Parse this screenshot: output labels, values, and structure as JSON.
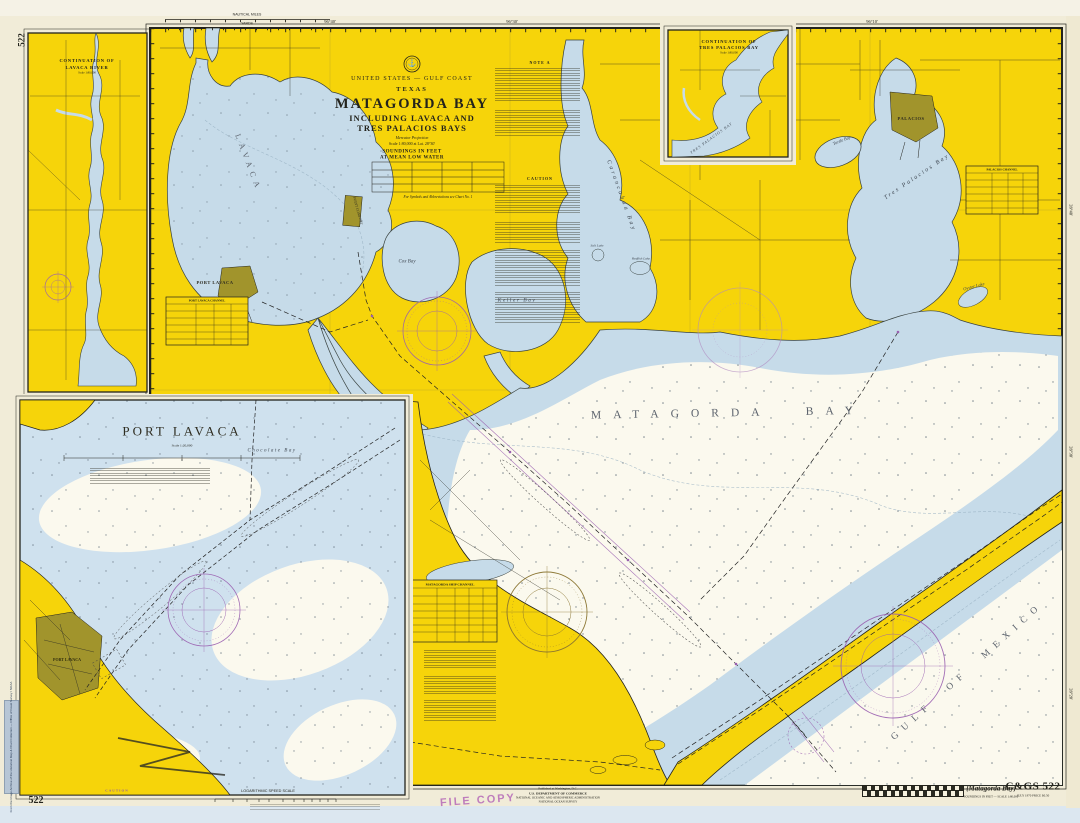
{
  "sheet": {
    "corner_number": "522",
    "chart_number": "C&GS 522",
    "chart_number_sub": "JULY 1970      PRICE $0.50",
    "bracket_title": "{Matagorda Bay}",
    "bracket_sub": "SOUNDINGS IN FEET — SCALE 1:80,000",
    "file_stamp": "FILE COPY",
    "publisher_l1": "Published at Washington, D.C.",
    "publisher_l2": "U.S. DEPARTMENT OF COMMERCE",
    "publisher_l3": "NATIONAL OCEANIC AND ATMOSPHERIC ADMINISTRATION",
    "publisher_l4": "NATIONAL OCEAN SURVEY",
    "archive_sticker": "From the Image Archive of the Historical Map & Chart Collection — Office of Coast Survey / NOAA",
    "speed_scale_label": "LOGARITHMIC SPEED SCALE",
    "speed_scale_note": "To find SPEED, place one point of dividers on minutes run, the other on distance run; with same spread place right point on 60 — left point indicates speed in knots.",
    "caution_bottom_title": "CAUTION",
    "scale_miles": "NAUTICAL MILES",
    "scale_yards": "YARDS"
  },
  "title_block": {
    "region": "UNITED STATES — GULF COAST",
    "state": "TEXAS",
    "title": "MATAGORDA BAY",
    "subtitle1": "INCLUDING LAVACA AND",
    "subtitle2": "TRES PALACIOS BAYS",
    "projection": "Mercator Projection",
    "scale": "Scale 1:80,000 at Lat. 28°30'",
    "soundings": "SOUNDINGS IN FEET",
    "datum": "AT MEAN LOW WATER",
    "symbols_note": "For Symbols and Abbreviations see Chart No. 1"
  },
  "insets": {
    "lavaca_river": {
      "title": "CONTINUATION OF",
      "title2": "LAVACA RIVER",
      "scale": "Scale 1:80,000"
    },
    "tres_palacios": {
      "title": "CONTINUATION OF",
      "title2": "TRES PALACIOS BAY",
      "scale": "Scale 1:80,000",
      "bay_label": "TRES PALACIOS BAY"
    },
    "port_lavaca": {
      "title": "PORT LAVACA",
      "scale": "Scale 1:20,000",
      "town": "PORT LAVACA"
    }
  },
  "map_labels": {
    "matagorda_bay": "MATAGORDA BAY",
    "gulf_of_mexico": "GULF OF MEXICO",
    "lavaca_bay": "LAVACA",
    "carancahua_bay": "Carancahua Bay",
    "tres_palacios_bay": "Tres Palacios Bay",
    "cox_bay": "Cox Bay",
    "keller_bay": "Keller Bay",
    "chocolate_bay": "Chocolate Bay",
    "turtle_bay": "Turtle Bay",
    "oyster_lake": "Oyster Lake",
    "salt_lake": "Salt Lake",
    "redfish_lake": "Redfish Lake",
    "port_lavaca": "PORT LAVACA",
    "point_comfort": "POINT COMFORT",
    "palacios": "PALACIOS",
    "note_a": "NOTE A",
    "caution": "CAUTION"
  },
  "tables": {
    "ship_channel": "MATAGORDA SHIP CHANNEL",
    "port_lavaca_channel": "PORT LAVACA CHANNEL",
    "palacios_channel": "PALACIOS CHANNEL"
  },
  "graticule": {
    "top": [
      "96°40'",
      "96°30'",
      "96°10'"
    ],
    "right": [
      "28°40'",
      "28°30'",
      "28°20'"
    ]
  },
  "colors": {
    "land": "#f6d40a",
    "shoal_water": "#c6dbe9",
    "deep_water": "#fbf9ee",
    "magenta": "#9a5fb0",
    "urban": "#a1942c"
  }
}
